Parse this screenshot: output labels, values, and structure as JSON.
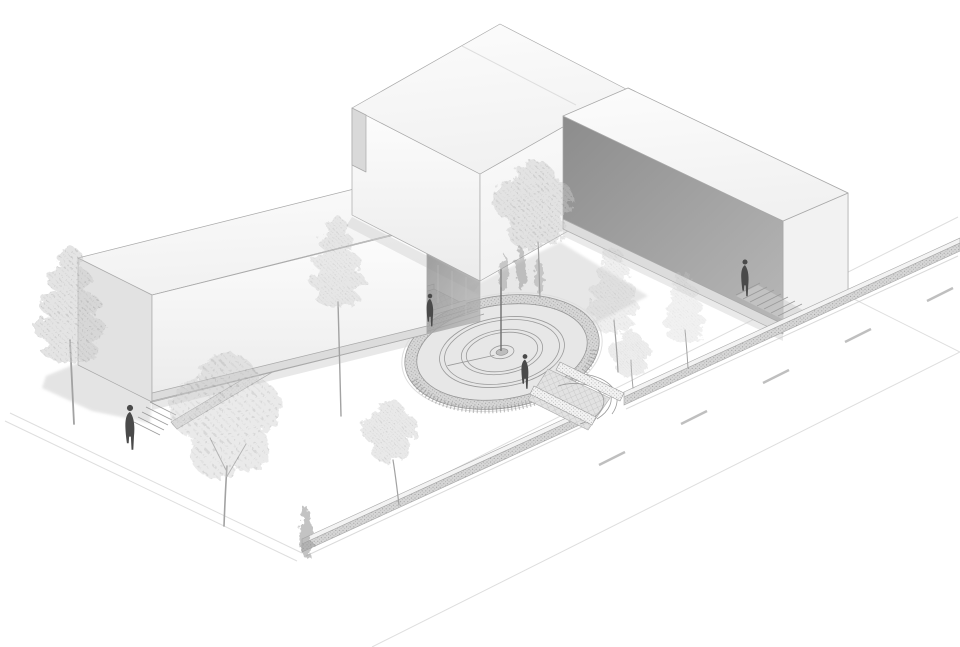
{
  "meta": {
    "title": "Axonometric architectural site rendering",
    "view": "aerial axonometric, monochrome line-and-tone illustration",
    "subject": "L-shaped slab building complex with sunken circular sundial plaza, lawn, trees and street"
  },
  "palette": {
    "bg": "#ffffff",
    "outline": "#a9a9a9",
    "linefaint": "#dedede",
    "linemid": "#c2c2c2",
    "roofhi": "#fcfcfc",
    "rooflo": "#f1f1f1",
    "facehi": "#fdfdfd",
    "facelo": "#ebebeb",
    "gable": "#e2e2e2",
    "sliver": "#d9d9d9",
    "darkhi": "#8c8c8c",
    "darklo": "#b7b7b7",
    "terrace": "#dcdcdc",
    "shadow": "#cbcbcb",
    "plazafloor": "#e7e7e7",
    "plazawall": "#d6d6d6",
    "ringstroke": "#9a9a9a",
    "deck": "#e2e2e2",
    "walltop": "#f3f3f3",
    "dash": "#bfbfbf",
    "treesoft": "#cdcdcd",
    "treedark": "#9b9b9b",
    "trunk": "#a2a2a2",
    "figure": "#4a4a4a",
    "gnomon": "#6e6e6e"
  },
  "scene": {
    "buildings": [
      {
        "name": "west-bar",
        "form": "long low white slab running northeast, stepped entry at west end"
      },
      {
        "name": "tall-block",
        "form": "taller white box riding over the bar at the junction"
      },
      {
        "name": "east-wing",
        "form": "slab running southeast with dark shaded courtyard wall and terrace"
      }
    ],
    "plaza": {
      "name": "sunken circular sundial plaza",
      "gnomon": true,
      "concentric_double_rings": 2,
      "perimeter": "stippled stone ring wall",
      "entrances": [
        "northwest footbridge with grid deck and rails",
        "southeast stepped exit with fanned steps through street wall"
      ]
    },
    "figures": {
      "count": 4,
      "locations": [
        "west lawn by building steps",
        "northwest footbridge",
        "plaza floor right of gnomon",
        "east terrace stair"
      ]
    },
    "trees": {
      "pines": 4,
      "deciduous": 4,
      "cypresses": 4
    },
    "street": {
      "lane_dashes": 5,
      "low_stippled_wall": "along sidewalk, interrupted by plaza exit",
      "orientation": "southeast edge of site"
    }
  }
}
